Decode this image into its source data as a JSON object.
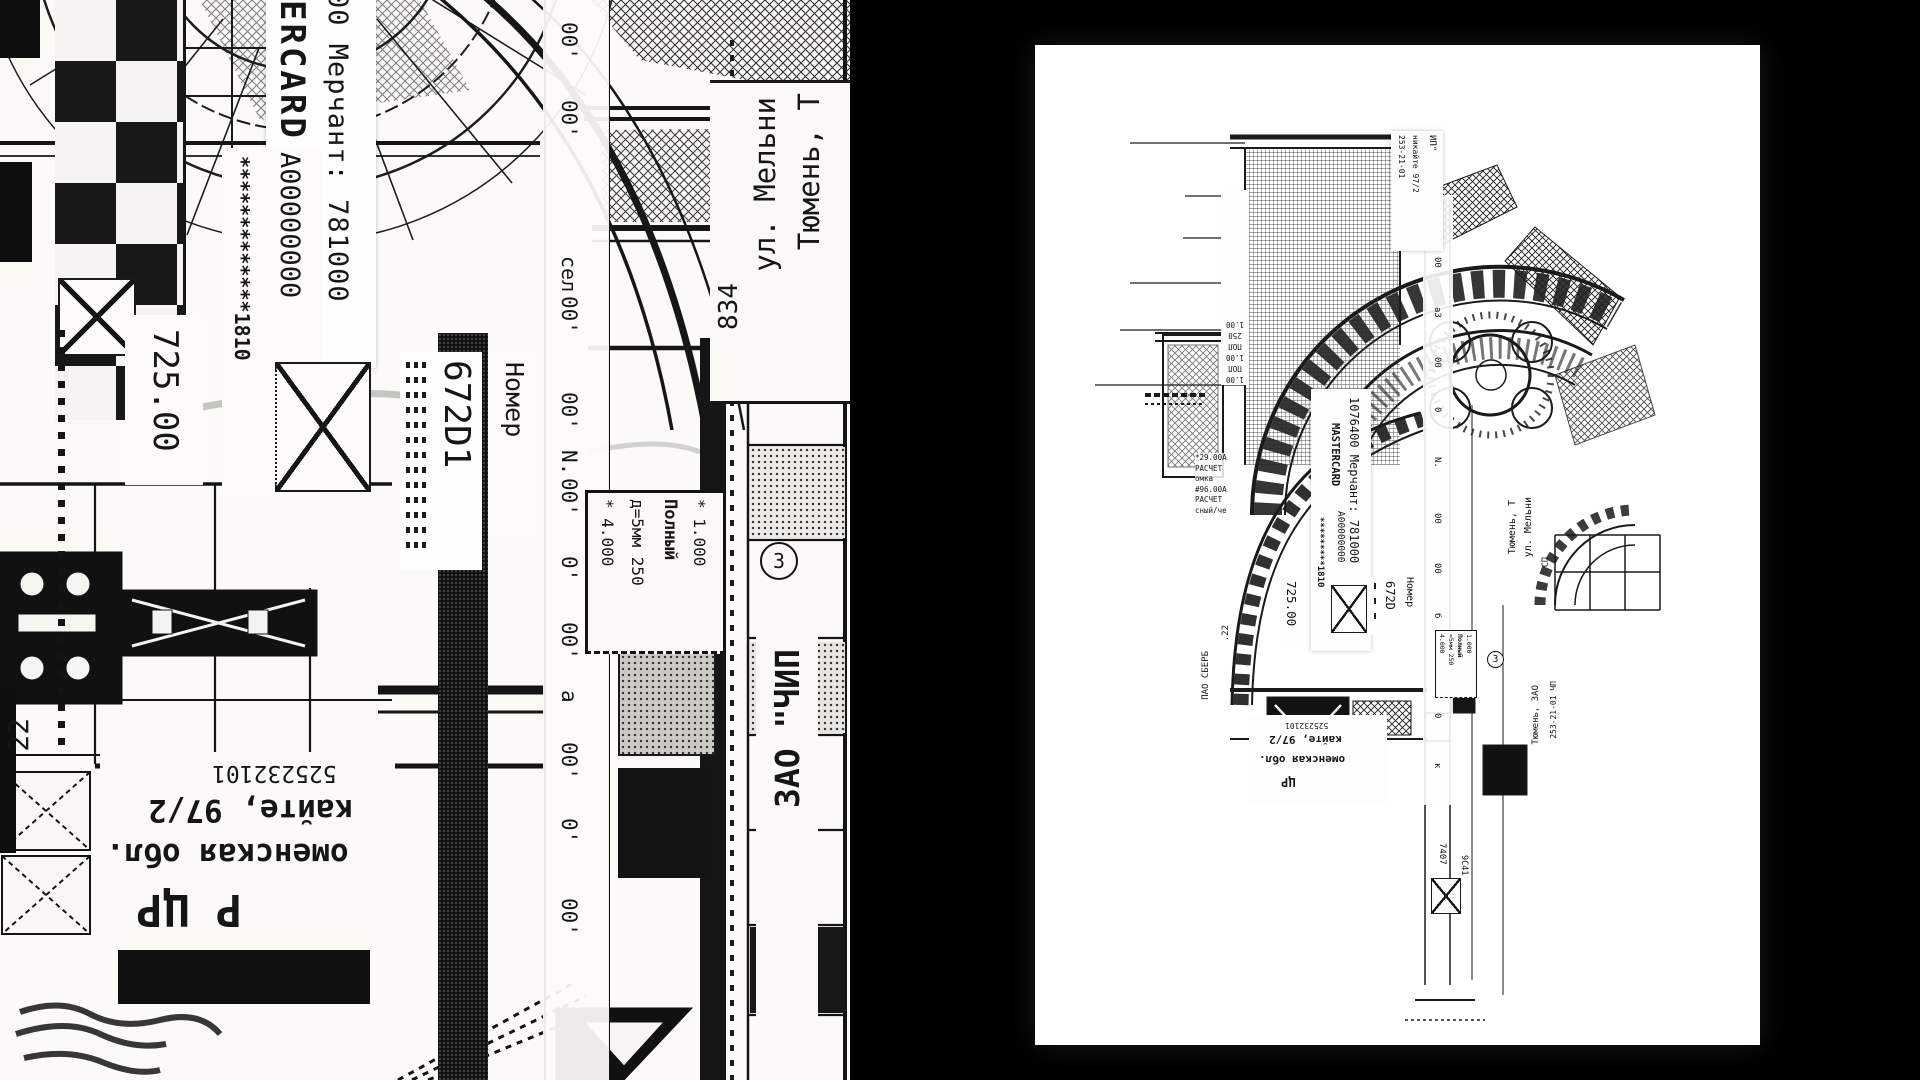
{
  "window": {
    "title": "Black-and-white collage artwork — detail crop and full sheet"
  },
  "left_panel": {
    "receipt_top": {
      "merchant": "00 Мерчант: 781000",
      "brand": "ERCARD"
    },
    "card": {
      "mask": "*************1810",
      "auth": "А00000000",
      "amount": "725.00",
      "code": "672D1",
      "nomer": "Номер"
    },
    "zeros": [
      "00'",
      "00'",
      "сел",
      "00'",
      "00'",
      "N.",
      "00'",
      "0'",
      "00'",
      "а",
      "00'",
      "0'",
      "00'"
    ],
    "tariff": {
      "l1": "* 1.000",
      "l2": "Полный",
      "l3": "д=5мм 250",
      "l4": "* 4.000"
    },
    "circle3": "3",
    "address": {
      "city": "Тюмень, Т",
      "street": "ул. Мельни",
      "num": "834"
    },
    "zao": "ЗАО \"ЧИП",
    "reversed": {
      "num": "525232101",
      "l1": "кайте, 97/2",
      "l2": "оменская обл.",
      "l3": "Р ЦР"
    },
    "edge": {
      "n22": "22"
    }
  },
  "artwork": {
    "top_strip": {
      "l1": "ИП\"",
      "l2": "никайте 97/2",
      "l3": "253-21-01"
    },
    "wall_tags": [
      "1.00",
      "ПОЛ",
      "1.00",
      "ПОЛ",
      "250",
      "1.00"
    ],
    "receipt": {
      "merchant": "1076400 Мерчант: 781000",
      "brand": "MASTERCARD",
      "auth": "А00000000",
      "mask": "*********1810",
      "amount": "725.00",
      "code": "672D",
      "nomer": "Номер"
    },
    "calc": [
      "*29.00А",
      "РАСЧЕТ",
      "омка",
      "#96.00А",
      "РАСЧЕТ",
      "сный/че"
    ],
    "zeros": [
      "00",
      "00",
      "а3",
      "00",
      "0",
      "N.",
      "00",
      "00",
      "б",
      "00",
      "0",
      "к"
    ],
    "tariff": {
      "l1": "1.000",
      "l2": "Полный",
      "l3": "=5мм 250",
      "l4": "4.000"
    },
    "circle3": "3",
    "address": {
      "city": "Тюмень, Т",
      "street": "ул. Мельни",
      "sp": "СП"
    },
    "sber": {
      "bank": "ПАО СБЕРБ",
      "n22": ".22"
    },
    "reversed": {
      "num": "525232101",
      "l1": "кайте, 97/2",
      "l2": "оменская обл.",
      "l3": "ЦР"
    },
    "right_strip": {
      "l1": "Тюмень, ЗАО",
      "l2": "253-21-01 ЧП"
    },
    "bottom": {
      "code": "7407",
      "code2": "9С41"
    }
  }
}
